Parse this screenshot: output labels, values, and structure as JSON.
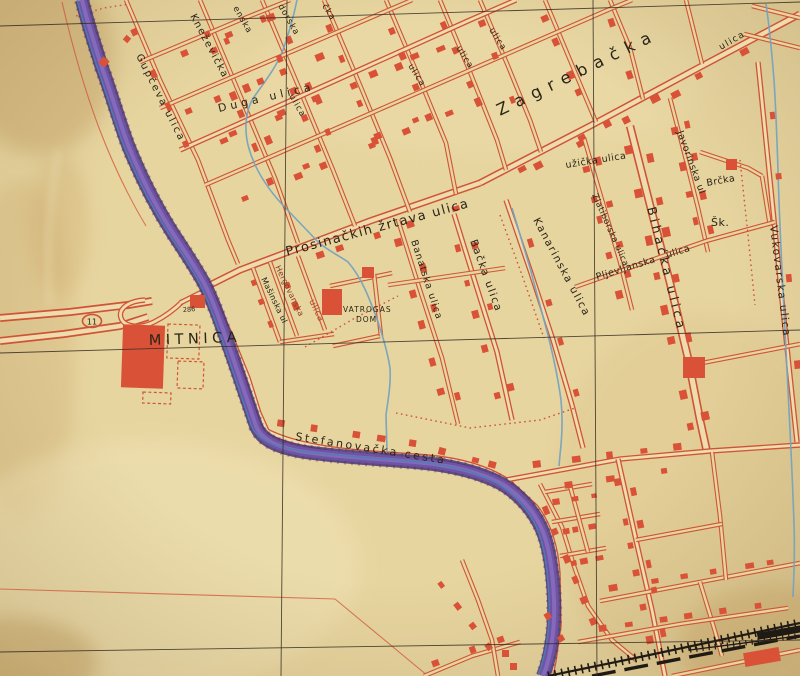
{
  "map_labels": [
    {
      "id": "gupceva",
      "text": "Gupčeva ulica"
    },
    {
      "id": "knezevicka",
      "text": "Kneževička"
    },
    {
      "id": "frag-enska",
      "text": "enska"
    },
    {
      "id": "frag-dorska",
      "text": "dorska"
    },
    {
      "id": "frag-cka",
      "text": "čka"
    },
    {
      "id": "duga",
      "text": "Duga ulica"
    },
    {
      "id": "ulica-q3",
      "text": "ulica"
    },
    {
      "id": "ulica-q5",
      "text": "ulica"
    },
    {
      "id": "ulica-q6",
      "text": "ulica"
    },
    {
      "id": "ulica-q7",
      "text": "ulica"
    },
    {
      "id": "zagrebacka",
      "text": "Zagrebačka"
    },
    {
      "id": "prosinackih",
      "text": "Prosinačkih žrtava ulica"
    },
    {
      "id": "uzicka",
      "text": "užička ulica"
    },
    {
      "id": "javorinska",
      "text": "Javorinska ul"
    },
    {
      "id": "brcka",
      "text": "Brčka"
    },
    {
      "id": "skola",
      "text": "Šk."
    },
    {
      "id": "bihacka",
      "text": "Bihaćka ulica"
    },
    {
      "id": "zlatiborska",
      "text": "Zlatiborska ulica"
    },
    {
      "id": "pljevljanska",
      "text": "Pljevljanska"
    },
    {
      "id": "pljevljanska-ulica",
      "text": "ulica"
    },
    {
      "id": "kanarinska",
      "text": "Kanarinska ulica"
    },
    {
      "id": "banatska",
      "text": "Banatska ulica"
    },
    {
      "id": "backa",
      "text": "Bačka ulica"
    },
    {
      "id": "vukovarska",
      "text": "Vukovarska ulica"
    },
    {
      "id": "mitnica",
      "text": "MITNICA"
    },
    {
      "id": "vatrogas-line1",
      "text": "VATROGAS"
    },
    {
      "id": "vatrogas-line2",
      "text": "DOM"
    },
    {
      "id": "stefanovacka",
      "text": "Stefanovačka cesta"
    },
    {
      "id": "masinska",
      "text": "Mašinska ul"
    },
    {
      "id": "hergovanska",
      "text": "Hergovanska"
    },
    {
      "id": "ulica-red",
      "text": "ulica"
    },
    {
      "id": "ulica-topright",
      "text": "ulica"
    },
    {
      "id": "route-number",
      "text": "11"
    },
    {
      "id": "elevation-286",
      "text": "286"
    }
  ],
  "colors": {
    "paper": "#e7d5a0",
    "road_fill": "#eedcae",
    "street": "#cf5436",
    "building": "#d95237",
    "river_dark": "#4a3478",
    "river_mid": "#6f54a6",
    "river_light": "#8a6fc0",
    "water_line": "#4d7fb0",
    "stream": "#74a3c0",
    "ink": "#2b2418",
    "rail": "#1f1a14",
    "grid": "#352c22"
  }
}
